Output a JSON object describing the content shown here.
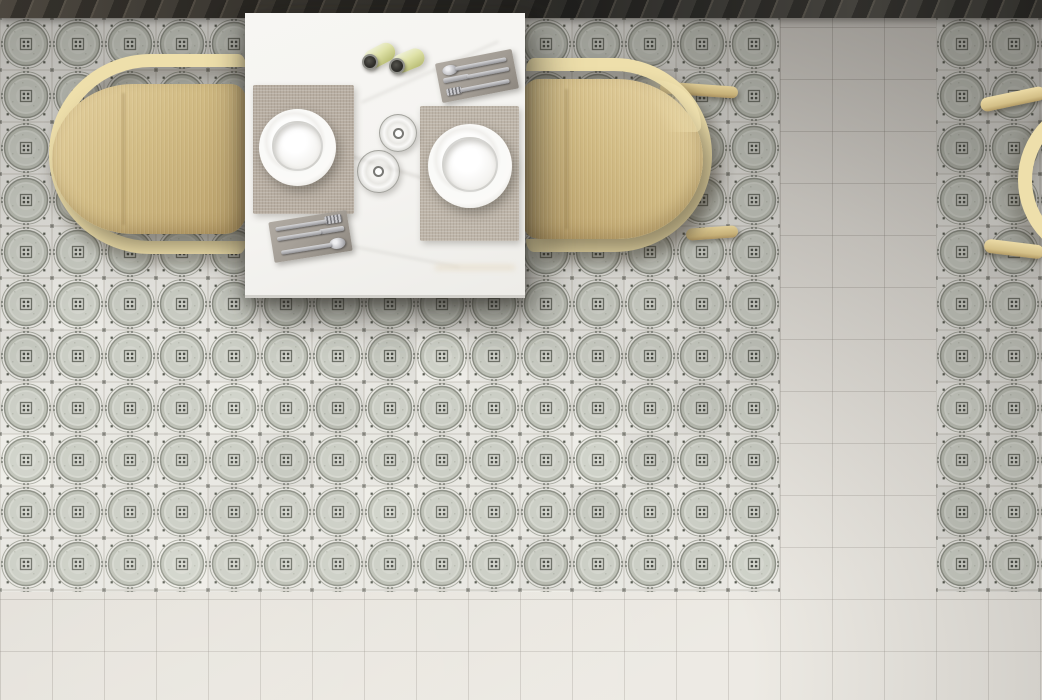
{
  "scene": {
    "type": "interior-photograph",
    "view": "top-down overhead",
    "description": "Overhead view of a small dining set: a white marble table laid with two white plates on woven placemats, two glasses, two pale-green capped bottles and two gray cutlery mats with silver fork, knife and spoon; the table is flanked by two pale bentwood armchairs on a gray circle-and-star patterned cement tile floor; plain light tile walkways run along the right side and bottom, a dark plank strip runs along the top edge, and the hoop frame of a third chair enters from the right edge."
  },
  "colors": {
    "tile-bg": "#e8e7e2",
    "tile-disc-edge": "#bcbfb5",
    "tile-disc": "#cbcec5",
    "tile-disc-center": "#d7d9d1",
    "tile-ring": "#8b8e84",
    "tile-echo": "#a6a89e",
    "tile-square": "#6e7168",
    "tile-dot": "#4a4d46",
    "tile-corner-dot": "#3e413b",
    "tile-sat-dot": "#54574e",
    "tile-edge-dot": "#686b62",
    "tile-seam": "#c2c0b8",
    "plain-tile": "#e8e5df",
    "table-top": "#f5f4f1",
    "marble-vein": "#d6d4cf",
    "chair-frame": "#eedfab",
    "chair-seat-light": "#e2ce9c",
    "chair-seat": "#d2bc85",
    "chair-seat-dark": "#bda46e",
    "placemat": "#b8aea2",
    "placemat2": "#beb5a9",
    "cutlery-mat": "#a29c94",
    "silver-light": "#d8d8da",
    "silver-dark": "#96969a",
    "plate": "#fbfaf8",
    "bottle-body": "#dfe2a8",
    "bottle-body-dark": "#b9bd74",
    "bottle-cap": "#32312d"
  },
  "floor": {
    "tile_size_px": 52,
    "pattern_name": "circle-and-star encaustic cement tile",
    "areas": [
      {
        "id": "pattern-main",
        "cols": 15,
        "rows": 12
      },
      {
        "id": "pattern-right",
        "cols": 3,
        "rows": 12
      }
    ],
    "plain_tile_note": "plain light tiles on right strip and bottom band",
    "top_strip_note": "dark diagonal plank strip along top edge"
  },
  "furniture": {
    "table": {
      "material": "white marble",
      "shape": "rectangular"
    },
    "chairs": [
      {
        "id": "chair-left",
        "style": "bentwood armchair",
        "finish": "pale birch"
      },
      {
        "id": "chair-right",
        "style": "bentwood armchair",
        "finish": "pale birch"
      },
      {
        "id": "chair-far-right",
        "style": "bentwood armchair (partial, at right edge)",
        "finish": "pale birch"
      }
    ]
  },
  "tableware": {
    "plates": [
      {
        "id": "plate-left",
        "color": "white",
        "type": "rimmed plate"
      },
      {
        "id": "plate-right",
        "color": "white",
        "type": "rimmed soup plate"
      }
    ],
    "placemats": [
      {
        "id": "placemat-left",
        "material": "woven",
        "color": "taupe"
      },
      {
        "id": "placemat-right",
        "material": "woven",
        "color": "beige"
      }
    ],
    "glasses": [
      {
        "id": "glass-1",
        "type": "stemmed glass, empty"
      },
      {
        "id": "glass-2",
        "type": "stemmed glass, empty"
      }
    ],
    "bottles": [
      {
        "id": "bottle-1",
        "body": "pale yellow-green",
        "cap": "black"
      },
      {
        "id": "bottle-2",
        "body": "pale yellow-green",
        "cap": "black"
      }
    ],
    "cutlery_sets": [
      {
        "id": "cutmat-top",
        "mat": "gray",
        "items": [
          "spoon",
          "knife",
          "fork"
        ]
      },
      {
        "id": "cutmat-bottom",
        "mat": "gray",
        "items": [
          "fork",
          "knife",
          "spoon"
        ]
      }
    ]
  }
}
